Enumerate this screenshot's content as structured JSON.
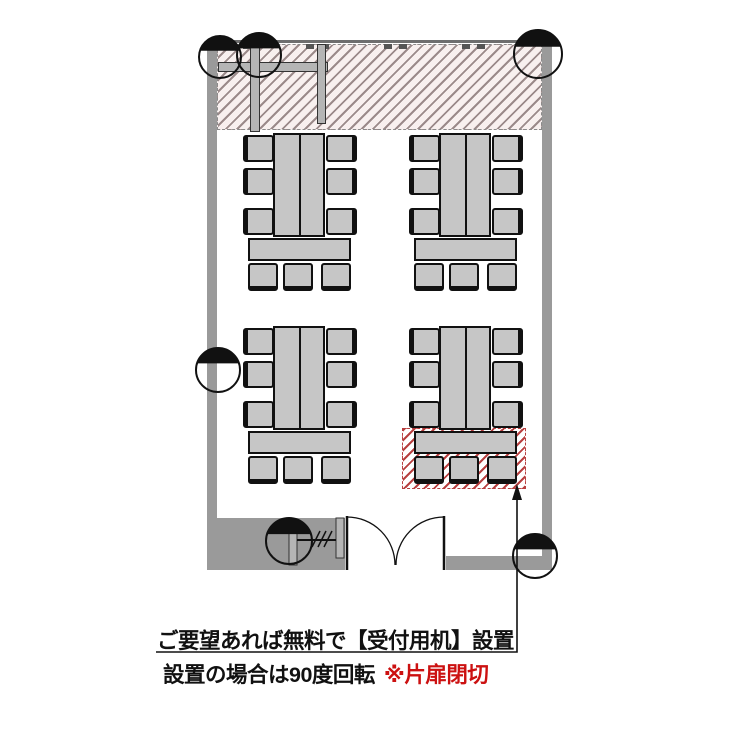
{
  "annotation": {
    "line1": "ご要望あれば無料で【受付用机】設置",
    "line2": "設置の場合は90度回転",
    "line2_note": "※片扉閉切"
  },
  "colors": {
    "wall": "#9a9a9a",
    "furniture": "#c6c6c6",
    "outline": "#111111",
    "hatch-top-line": "#9b8a8a",
    "hatch-top-bg": "#f8f0ef",
    "hatch-reception": "#b84040",
    "note-red": "#cc1111"
  },
  "floorplan": {
    "table_groups": 4,
    "chairs_per_group": 9,
    "door_type": "double-swing",
    "column_symbols": 6,
    "reception_area_marked": true
  }
}
